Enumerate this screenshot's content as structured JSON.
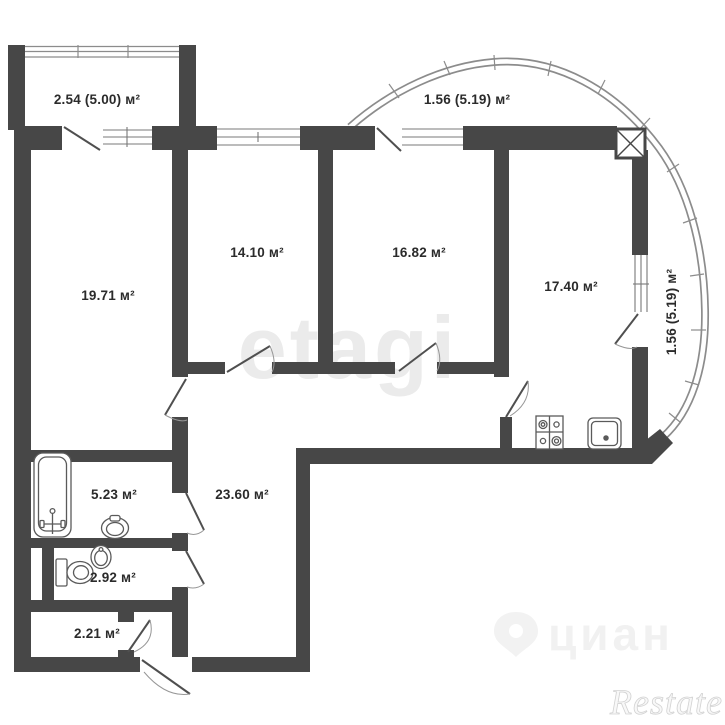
{
  "plan": {
    "rooms": [
      {
        "name": "balcony-top-left",
        "area": "2.54 (5.00) м²"
      },
      {
        "name": "balcony-top-right",
        "area": "1.56 (5.19) м²"
      },
      {
        "name": "living-room",
        "area": "19.71 м²"
      },
      {
        "name": "bedroom-1",
        "area": "14.10 м²"
      },
      {
        "name": "bedroom-2",
        "area": "16.82 м²"
      },
      {
        "name": "kitchen",
        "area": "17.40 м²"
      },
      {
        "name": "balcony-right",
        "area": "1.56 (5.19) м²"
      },
      {
        "name": "bathroom",
        "area": "5.23 м²"
      },
      {
        "name": "hallway",
        "area": "23.60 м²"
      },
      {
        "name": "toilet",
        "area": "2.92 м²"
      },
      {
        "name": "balcony-bottom",
        "area": "2.21 м²"
      }
    ],
    "fixtures": [
      "bathtub",
      "bidet",
      "toilet",
      "wash-basin",
      "stove",
      "kitchen-sink",
      "ventilation-shaft"
    ],
    "watermarks": {
      "center": "etagi",
      "portal": "циан",
      "corner": "Restate"
    },
    "colors": {
      "wall": "#474747",
      "background": "#ffffff",
      "glazing_line": "#8c8c8c",
      "label_text": "#2b2b2b",
      "watermark_light": "#ebebeb"
    }
  }
}
